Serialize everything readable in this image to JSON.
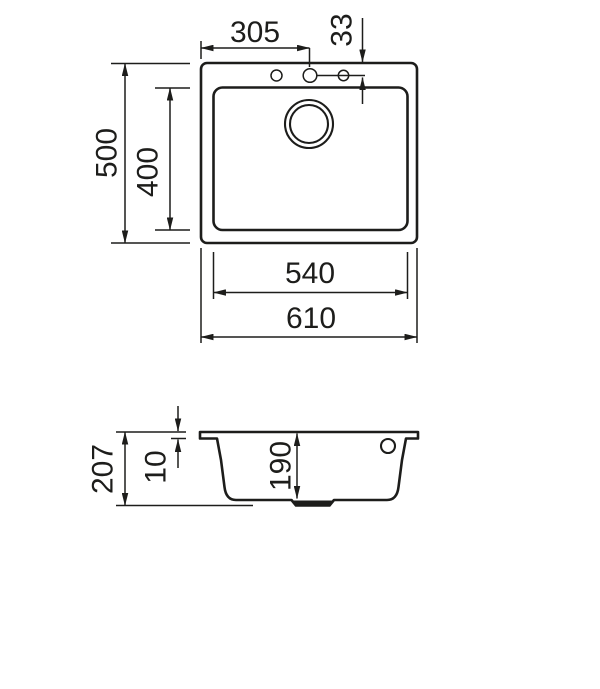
{
  "colors": {
    "background": "#ffffff",
    "line": "#1d1d1b"
  },
  "top_view": {
    "dim_overall_width": "610",
    "dim_overall_depth": "500",
    "dim_bowl_width": "540",
    "dim_bowl_depth": "400",
    "dim_tap_hole_center_x": "305",
    "dim_tap_hole_offset_y": "33"
  },
  "section_view": {
    "dim_overall_height": "207",
    "dim_rim_height": "10",
    "dim_bowl_inner_depth": "190"
  },
  "dimensions_mm": {
    "overall_width": 610,
    "overall_depth": 500,
    "bowl_width": 540,
    "bowl_depth": 400,
    "tap_hole_center_from_left": 305,
    "tap_hole_center_from_edge": 33,
    "overall_height": 207,
    "rim_height": 10,
    "bowl_inner_depth": 190
  }
}
